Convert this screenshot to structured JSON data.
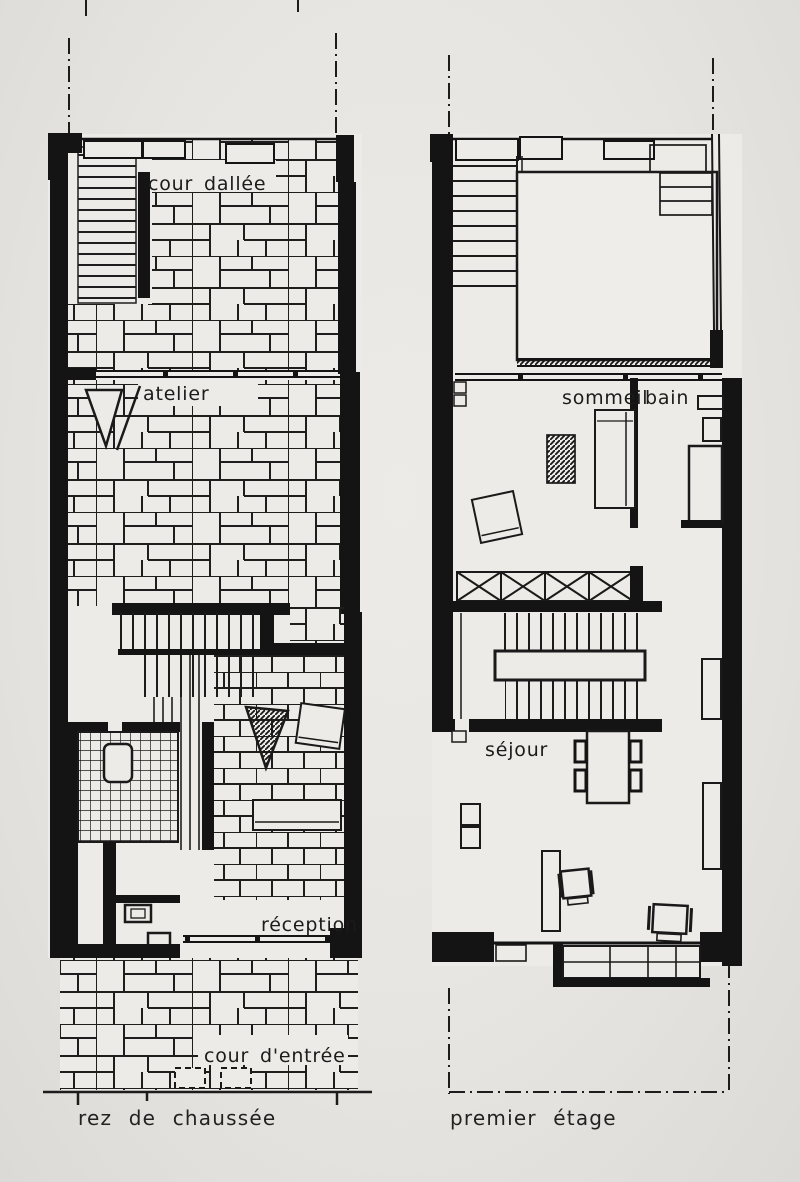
{
  "figure": {
    "type": "architectural floor plans, scanned book page",
    "ink_color": "#1a1a1a",
    "paper_color": "#e8e6e2"
  },
  "ground_floor": {
    "caption": "rez de chaussée",
    "labels": {
      "paved_court": "cour dallée",
      "workshop": "atelier",
      "reception": "réception",
      "entry_court": "cour d'entrée"
    }
  },
  "first_floor": {
    "caption": "premier étage",
    "labels": {
      "bedroom": "sommeil",
      "bath": "bain",
      "living_room": "séjour"
    }
  }
}
